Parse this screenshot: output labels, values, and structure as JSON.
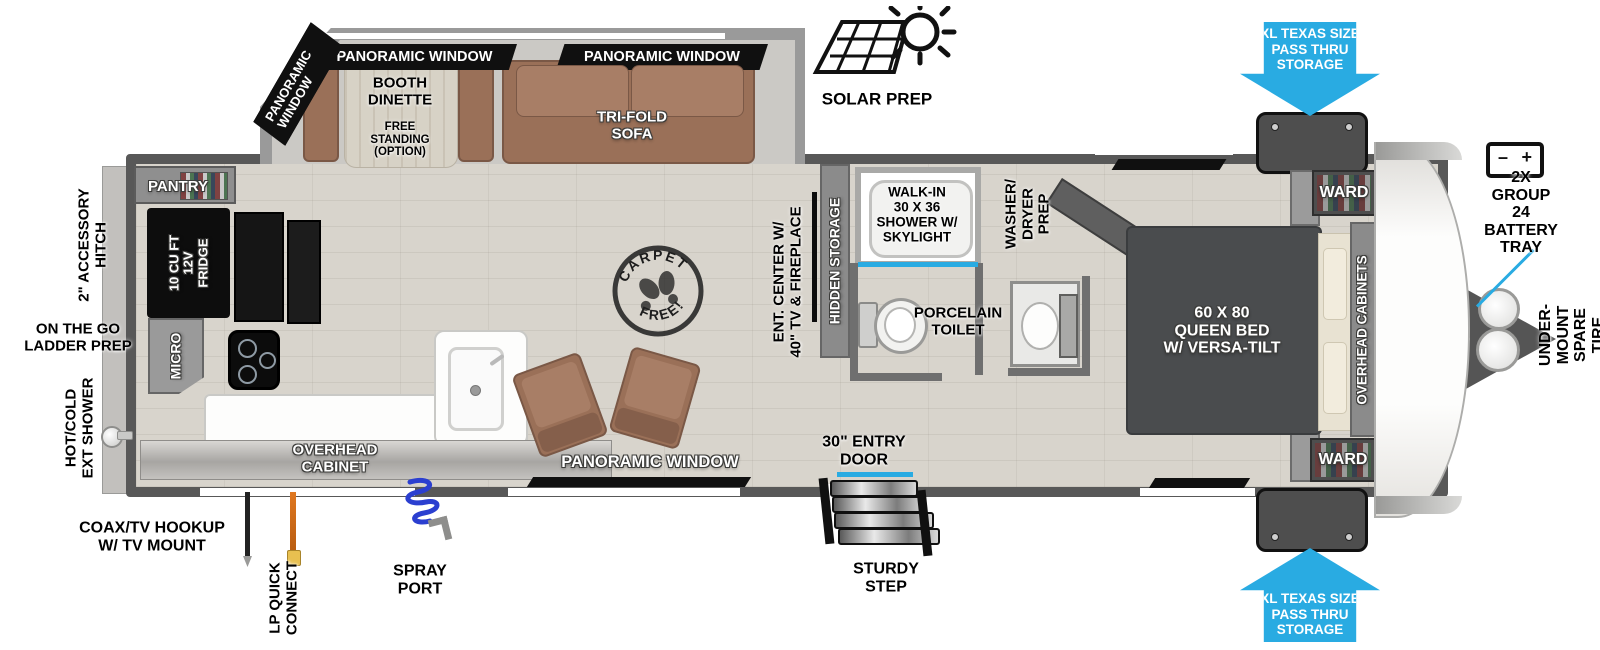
{
  "floorplan": {
    "windows": {
      "panoramic": "PANORAMIC WINDOW"
    },
    "slideout": {
      "booth_dinette": "BOOTH\nDINETTE",
      "free_standing": "FREE\nSTANDING\n(OPTION)",
      "tri_fold_sofa": "TRI-FOLD\nSOFA"
    },
    "kitchen": {
      "pantry": "PANTRY",
      "fridge": "10 CU FT\n12V\nFRIDGE",
      "micro": "MICRO",
      "overhead_cabinet": "OVERHEAD\nCABINET"
    },
    "living": {
      "ent_center": "ENT. CENTER W/\n40\" TV & FIREPLACE",
      "hidden_storage": "HIDDEN STORAGE",
      "carpet_free": {
        "top": "CARPET",
        "bottom": "FREE!"
      }
    },
    "bathroom": {
      "shower": "WALK-IN\n30 X 36\nSHOWER W/\nSKYLIGHT",
      "toilet": "PORCELAIN\nTOILET",
      "washer_dryer": "WASHER/\nDRYER\nPREP"
    },
    "bedroom": {
      "bed": "60 X 80\nQUEEN BED\nW/ VERSA-TILT",
      "overhead_cabinets": "OVERHEAD CABINETS",
      "wardrobe": "WARD"
    },
    "entry": {
      "door": "30\" ENTRY\nDOOR",
      "step": "STURDY\nSTEP"
    },
    "exterior": {
      "solar_prep": "SOLAR PREP",
      "pass_thru": "XL TEXAS SIZE\nPASS THRU\nSTORAGE",
      "battery_tray": "2X GROUP 24\nBATTERY\nTRAY",
      "battery_minus": "–",
      "battery_plus": "+",
      "spare_tire": "UNDER-MOUNT\nSPARE TIRE",
      "accessory_hitch": "2\" ACCESSORY\nHITCH",
      "ladder_prep": "ON THE GO\nLADDER PREP",
      "ext_shower": "HOT/COLD\nEXT SHOWER",
      "coax": "COAX/TV HOOKUP\nW/ TV MOUNT",
      "lp_quick_connect": "LP QUICK\nCONNECT",
      "spray_port": "SPRAY\nPORT"
    },
    "colors": {
      "arrow_blue": "#29ABE2",
      "accent_blue": "#29ABE2",
      "furniture_brown": "#9A7058",
      "wall_gray": "#6F6F6F",
      "bed_gray": "#4A4C4E"
    }
  }
}
